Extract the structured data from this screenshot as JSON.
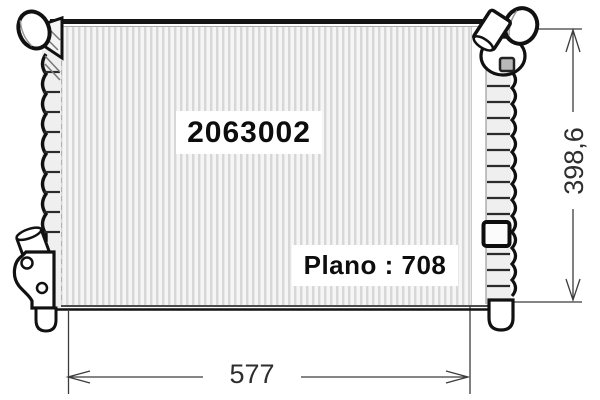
{
  "drawing": {
    "labels": {
      "part_number": "2063002",
      "plano": "Plano : 708"
    },
    "dimensions": {
      "width": "577",
      "height": "398,6"
    },
    "colors": {
      "background": "#ffffff",
      "line_art": "#141414",
      "dimension_line": "#3c3c3c",
      "stripe_dark": "#d7d7d7",
      "stripe_light": "#f5f5f5",
      "tank_fill": "#efefef",
      "fitting_gray": "#b9b9b9"
    }
  }
}
